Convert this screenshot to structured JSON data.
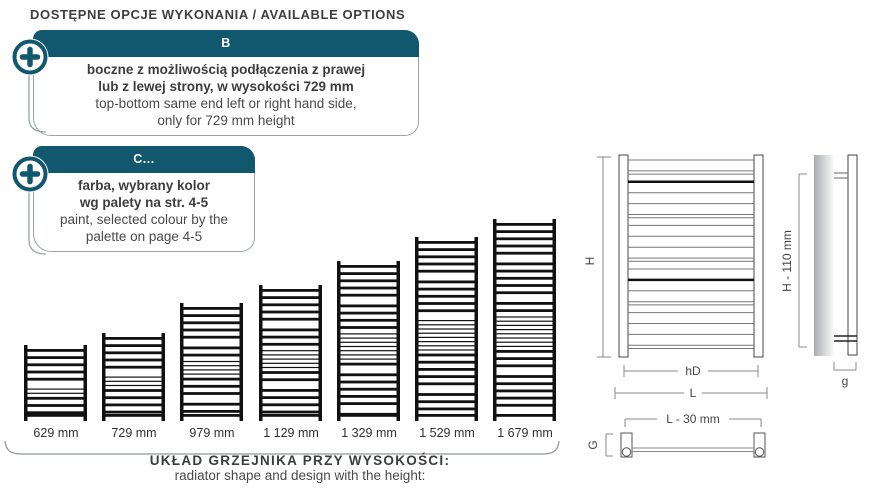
{
  "header": {
    "title": "DOSTĘPNE OPCJE WYKONANIA / AVAILABLE OPTIONS"
  },
  "options": [
    {
      "code": "B",
      "pl": [
        "boczne z możliwością podłączenia z prawej",
        "lub z lewej strony, w wysokości 729 mm"
      ],
      "en": [
        "top-bottom same end left or right hand side,",
        "only for 729 mm height"
      ]
    },
    {
      "code": "C...",
      "pl": [
        "farba, wybrany kolor",
        "wg palety na str. 4-5"
      ],
      "en": [
        "paint, selected colour by the",
        "palette on page 4-5"
      ]
    }
  ],
  "radiators": {
    "items": [
      {
        "label": "629 mm",
        "mm": 629
      },
      {
        "label": "729 mm",
        "mm": 729
      },
      {
        "label": "979 mm",
        "mm": 979
      },
      {
        "label": "1 129 mm",
        "mm": 1129
      },
      {
        "label": "1 329 mm",
        "mm": 1329
      },
      {
        "label": "1 529 mm",
        "mm": 1529
      },
      {
        "label": "1 679 mm",
        "mm": 1679
      }
    ],
    "caption_pl": "UKŁAD GRZEJNIKA PRZY WYSOKOŚCI:",
    "caption_en": "radiator shape and design with the height:"
  },
  "diagram": {
    "front": {
      "height_label": "H",
      "inner_width_label": "hD",
      "width_label": "L"
    },
    "side": {
      "height_label": "H - 110 mm",
      "depth_label": "g"
    },
    "top": {
      "width_label": "L - 30 mm",
      "depth_label": "G"
    }
  },
  "colors": {
    "teal": "#11586e",
    "border_gray": "#9aa4a8",
    "text_dark": "#3d3d3d",
    "drawing_black": "#111111",
    "dimension_gray": "#8a8a8a"
  }
}
